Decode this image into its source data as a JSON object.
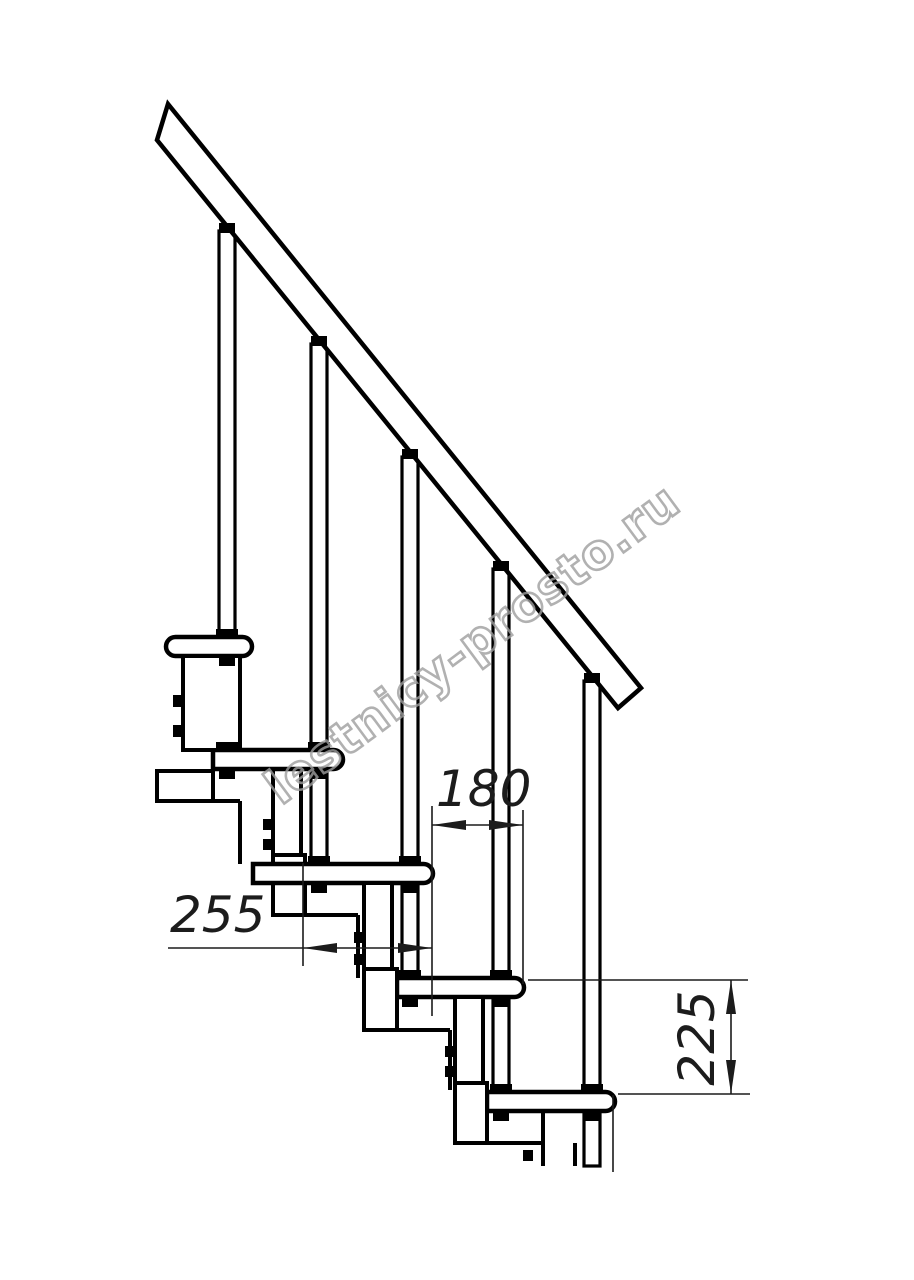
{
  "drawing": {
    "kind": "modular-staircase-side-view-technical-drawing",
    "steps_count": 5,
    "balusters_count": 5,
    "dimensions": {
      "baluster_spacing": {
        "value": "180",
        "orientation": "horizontal"
      },
      "step_run": {
        "value": "255",
        "orientation": "horizontal"
      },
      "step_rise": {
        "value": "225",
        "orientation": "vertical"
      }
    },
    "watermark": {
      "text": "lestnicy-prosto.ru"
    },
    "colors": {
      "background": "#ffffff",
      "structure_line": "#000000",
      "dimension_line": "#1c1c1c",
      "watermark": "#9e9e9e"
    }
  }
}
